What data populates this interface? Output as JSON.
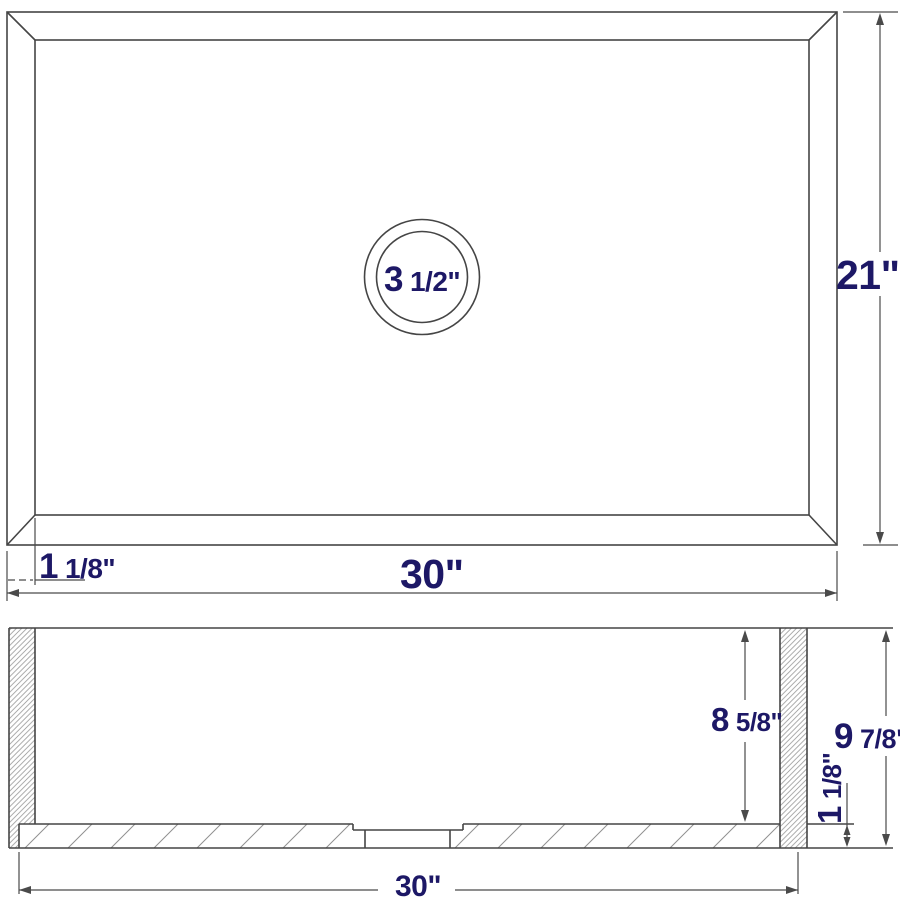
{
  "drawing_title": "Sink dimension drawing (plan and section views)",
  "plan": {
    "drain_whole": "3",
    "drain_frac": "1/2\"",
    "height_label": "21\"",
    "width_label": "30\"",
    "rim_whole": "1",
    "rim_frac": "1/8\""
  },
  "section": {
    "depth_whole": "8",
    "depth_frac": "5/8\"",
    "overall_whole": "9",
    "overall_frac": "7/8\"",
    "base_whole": "1",
    "base_frac": "1/8\"",
    "width_label": "30\""
  },
  "colors": {
    "line": "#454545",
    "dimension_text": "#1d1866",
    "hatch": "#8f8f8f",
    "background": "#ffffff"
  }
}
